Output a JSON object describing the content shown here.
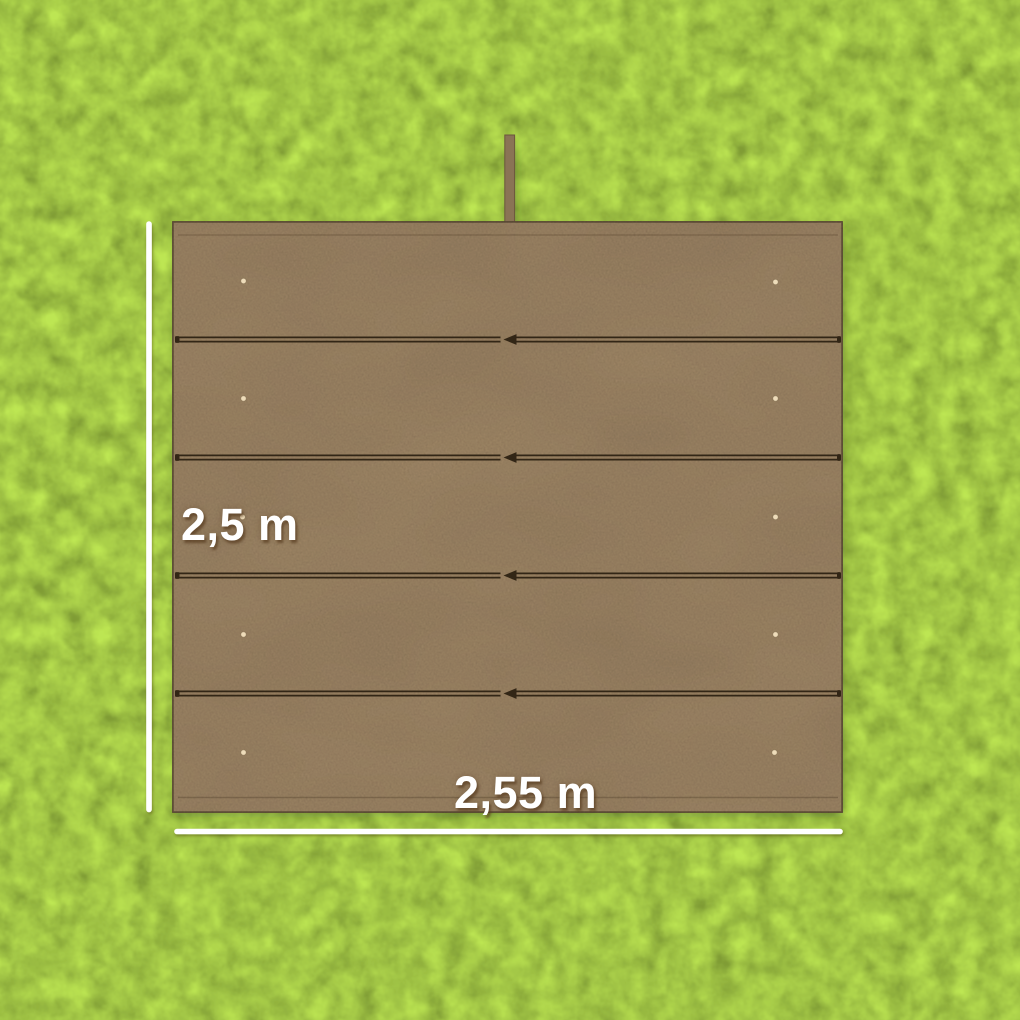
{
  "scene": {
    "description": "Aerial product view: brown five-panel tarpaulin cover laid flat on a lawn, annotated with white dimension lines",
    "dimension_labels": {
      "height": "2,5 m",
      "width": "2,55 m"
    },
    "tarp": {
      "panel_count": 5,
      "seam_count": 4,
      "seam_arrow_direction": "left",
      "eyelet_rows": 5,
      "eyelet_columns": 2,
      "has_top_pole": true
    },
    "colors": {
      "grass_base": "#9fc244",
      "grass_light": "#bdd968",
      "grass_dark": "#5f8c2c",
      "tarp_base": "#927b5d",
      "tarp_pole": "#8a7354",
      "seam_dark": "#332513",
      "eyelet": "#eedcba",
      "dimension_line": "#ffffff",
      "label_text": "#ffffff"
    }
  }
}
